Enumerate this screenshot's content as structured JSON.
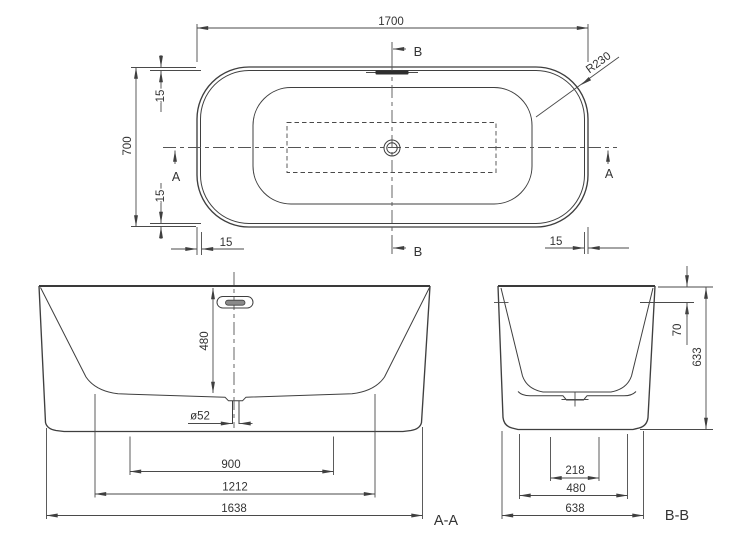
{
  "colors": {
    "line": "#3f3f3f",
    "deck_fill": "#e9e9e9",
    "basin_fill": "#f6f6f6",
    "overflow_dark": "#2e2e2e",
    "background": "#ffffff"
  },
  "plan": {
    "dim_length": "1700",
    "dim_width": "700",
    "dim_rim_top": "15",
    "dim_rim_bottom": "15",
    "dim_rim_left": "15",
    "dim_rim_right": "15",
    "dim_corner_radius": "R230",
    "marker_a_left": "A",
    "marker_a_right": "A",
    "marker_b_top": "B",
    "marker_b_bottom": "B"
  },
  "section_aa": {
    "label": "A-A",
    "dim_depth": "480",
    "dim_drain_diameter": "ø52",
    "dim_base_inner": "900",
    "dim_base": "1212",
    "dim_overall_length": "1638"
  },
  "section_bb": {
    "label": "B-B",
    "dim_overflow_drop": "70",
    "dim_height": "633",
    "dim_base_inner": "218",
    "dim_base": "480",
    "dim_overall_width": "638"
  }
}
